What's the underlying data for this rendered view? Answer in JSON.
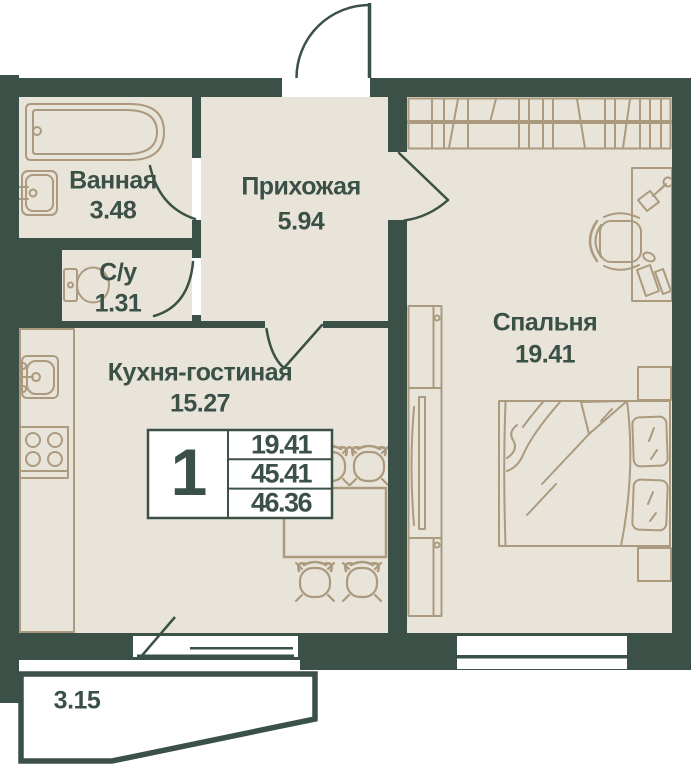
{
  "colors": {
    "wall": "#3b5147",
    "floor": "#e9e4da",
    "furniture_outline": "#ab9a7e",
    "paper": "#ffffff",
    "label_text": "#3b5147"
  },
  "rooms": {
    "bathroom": {
      "name": "Ванная",
      "area": "3.48"
    },
    "toilet": {
      "name": "С/у",
      "area": "1.31"
    },
    "hallway": {
      "name": "Прихожая",
      "area": "5.94"
    },
    "kitchen_living": {
      "name": "Кухня-гостиная",
      "area": "15.27"
    },
    "bedroom": {
      "name": "Спальня",
      "area": "19.41"
    },
    "balcony": {
      "area": "3.15"
    }
  },
  "info_table": {
    "rooms_count": "1",
    "living_area": "19.41",
    "area_without_balcony": "45.41",
    "total_area": "46.36"
  },
  "furniture_icons": [
    "bathtub-icon",
    "bathroom-sink-icon",
    "toilet-icon",
    "kitchen-counter-icon",
    "kitchen-sink-icon",
    "stove-icon",
    "dining-table-icon",
    "dining-chair-icon",
    "entrance-door-icon",
    "door-swing-icon",
    "wardrobe-icon",
    "side-wardrobe-icon",
    "bed-icon",
    "pillow-icon",
    "nightstand-icon",
    "desk-icon",
    "desk-lamp-icon",
    "office-chair-icon",
    "window-icon",
    "balcony-icon"
  ]
}
